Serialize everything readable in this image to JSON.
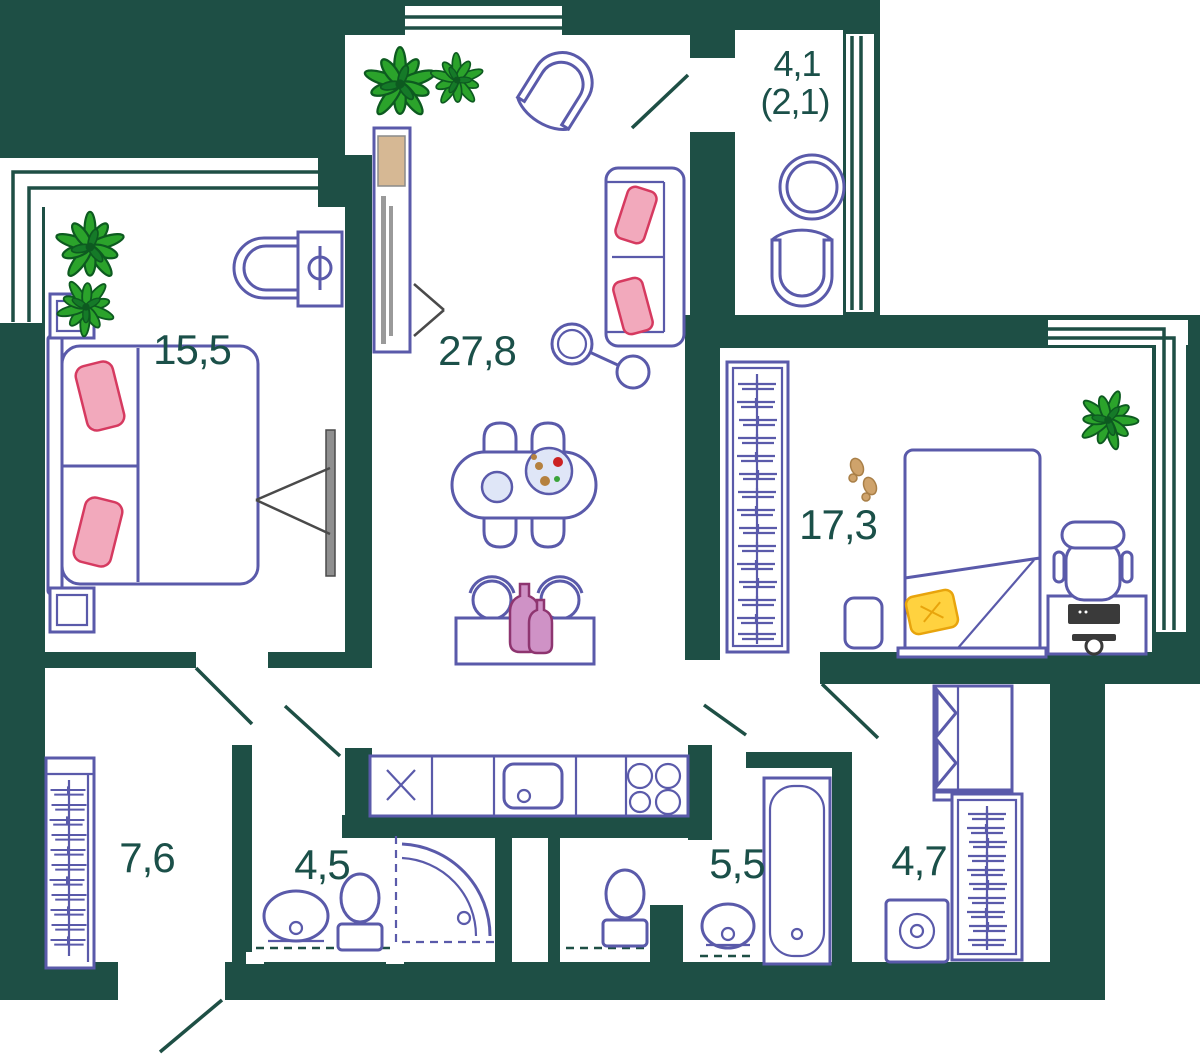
{
  "rooms": {
    "bedroom_main": {
      "area_label": "15,5"
    },
    "living_kitchen": {
      "area_label": "27,8"
    },
    "balcony": {
      "area_label": "4,1",
      "area_label_secondary": "(2,1)"
    },
    "bedroom_second": {
      "area_label": "17,3"
    },
    "hallway": {
      "area_label": "7,6"
    },
    "shower_room": {
      "area_label": "4,5"
    },
    "bathroom": {
      "area_label": "5,5"
    },
    "laundry_hall": {
      "area_label": "4,7"
    }
  },
  "colors": {
    "wall": "#1e4f45",
    "furniture_outline": "#5a5aaa",
    "label_text": "#1b5049",
    "plant_green": "#2ba32b",
    "pillow_pink": "#f2a9bc",
    "pillow_yellow": "#ffd23f",
    "vase_magenta": "#cf92c6",
    "wood_beige": "#d6b894"
  }
}
